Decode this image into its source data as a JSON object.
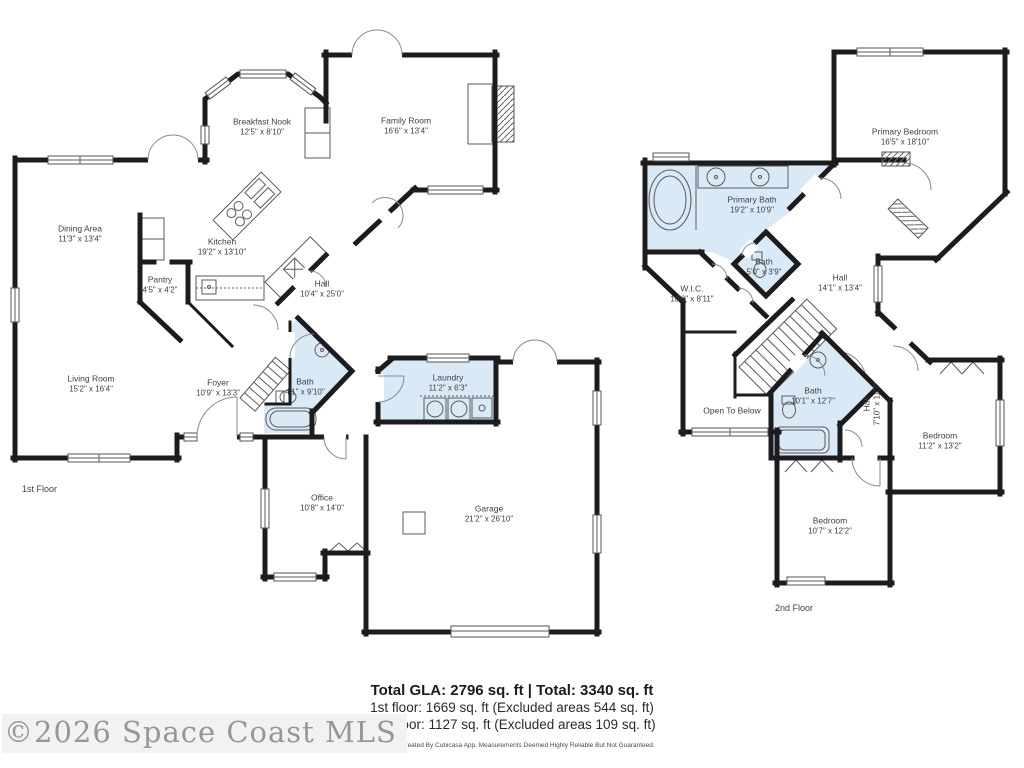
{
  "colors": {
    "wall": "#1c1c1e",
    "wet_area": "#d9eaf6",
    "label": "#3e3e45"
  },
  "floor1": {
    "label": "1st Floor",
    "rooms": [
      {
        "name": "Breakfast Nook",
        "dims": "12'5\" x 8'10\""
      },
      {
        "name": "Family Room",
        "dims": "16'6\" x 13'4\""
      },
      {
        "name": "Dining Area",
        "dims": "11'3\" x 13'4\""
      },
      {
        "name": "Kitchen",
        "dims": "19'2\" x 13'10\""
      },
      {
        "name": "Pantry",
        "dims": "4'5\" x 4'2\""
      },
      {
        "name": "Hall",
        "dims": "10'4\" x 25'0\""
      },
      {
        "name": "Living Room",
        "dims": "15'2\" x 16'4\""
      },
      {
        "name": "Foyer",
        "dims": "10'9\" x 13'3\""
      },
      {
        "name": "Bath",
        "dims": "4'1\" x 9'10\""
      },
      {
        "name": "Laundry",
        "dims": "11'2\" x 6'3\""
      },
      {
        "name": "Office",
        "dims": "10'8\" x 14'0\""
      },
      {
        "name": "Garage",
        "dims": "21'2\" x 26'10\""
      }
    ]
  },
  "floor2": {
    "label": "2nd Floor",
    "rooms": [
      {
        "name": "Primary Bedroom",
        "dims": "16'5\" x 18'10\""
      },
      {
        "name": "Primary Bath",
        "dims": "19'2\" x 10'9\""
      },
      {
        "name": "Bath",
        "dims": "5'0\" x 3'9\""
      },
      {
        "name": "W.I.C.",
        "dims": "10'6\" x 8'11\""
      },
      {
        "name": "Hall",
        "dims": "14'1\" x 13'4\""
      },
      {
        "name": "Open To Below",
        "dims": ""
      },
      {
        "name": "Bath",
        "dims": "10'1\" x 12'7\""
      },
      {
        "name": "Hall",
        "dims": "7'10\" x 11'7\""
      },
      {
        "name": "Bedroom",
        "dims": "11'2\" x 13'2\""
      },
      {
        "name": "Bedroom",
        "dims": "10'7\" x 12'2\""
      }
    ]
  },
  "summary": {
    "total": "Total GLA: 2796 sq. ft | Total: 3340 sq. ft",
    "floor1_line": "1st floor: 1669 sq. ft (Excluded areas 544 sq. ft)",
    "floor2_line": "2nd floor: 1127 sq. ft (Excluded areas 109 sq. ft)",
    "disclaimer": "Floor Plan Created By Cubicasa App. Measurements Deemed Highly Reliable But Not Guaranteed."
  },
  "watermark": "©2026 Space Coast MLS"
}
